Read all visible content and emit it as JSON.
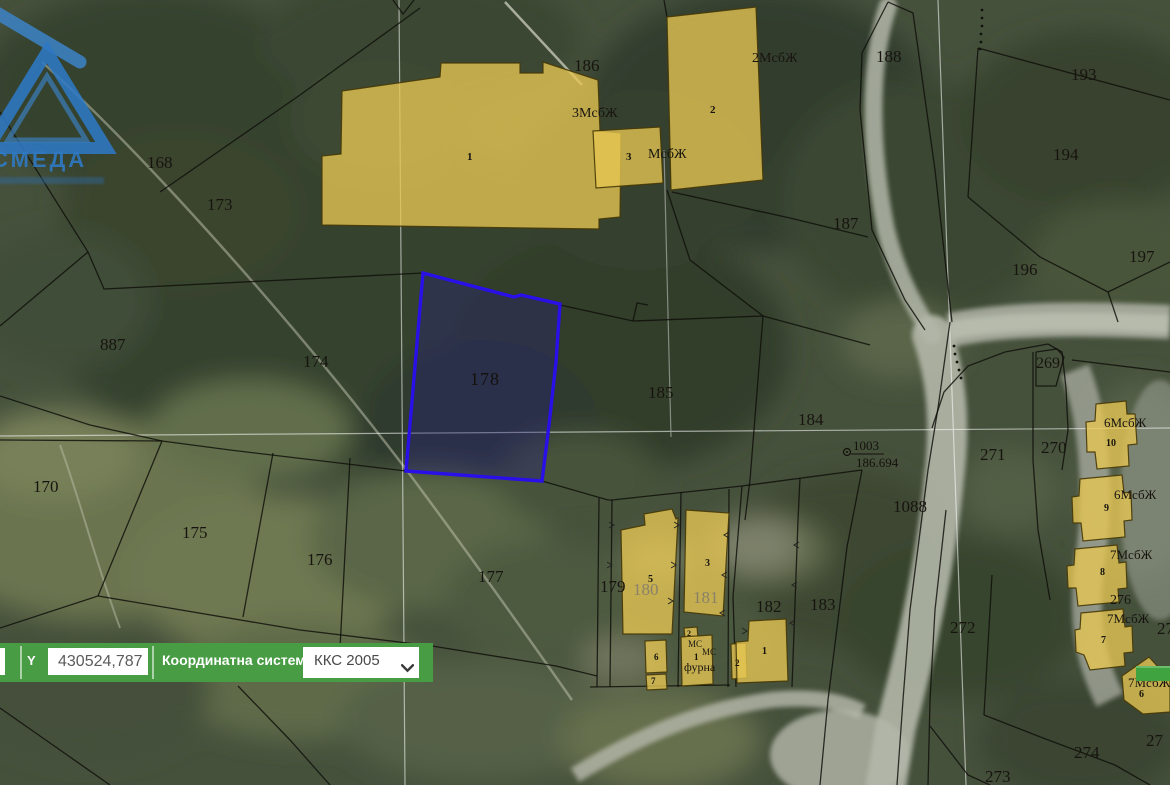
{
  "watermark": {
    "text": "СМЕДА"
  },
  "coordinate_bar": {
    "y_label": "Y",
    "y_value": "430524,787",
    "system_label": "Координатна система",
    "system_value": "ККС 2005"
  },
  "selected_parcel": {
    "number": "178"
  },
  "geodetic_point": {
    "id": "1003",
    "elevation": "186.694"
  },
  "colors": {
    "toolbar_green": "#489c44",
    "selection_blue": "#2a10e8",
    "building_yellow": "#e7c753"
  },
  "map": {
    "labels": [
      {
        "t": "168",
        "x": 147,
        "y": 168,
        "s": 17,
        "kind": "parcel-label"
      },
      {
        "t": "173",
        "x": 207,
        "y": 210,
        "s": 17,
        "kind": "parcel-label"
      },
      {
        "t": "887",
        "x": 100,
        "y": 350,
        "s": 17,
        "kind": "parcel-label"
      },
      {
        "t": "174",
        "x": 303,
        "y": 367,
        "s": 17,
        "kind": "parcel-label"
      },
      {
        "t": "170",
        "x": 33,
        "y": 492,
        "s": 17,
        "kind": "parcel-label"
      },
      {
        "t": "175",
        "x": 182,
        "y": 538,
        "s": 17,
        "kind": "parcel-label"
      },
      {
        "t": "176",
        "x": 307,
        "y": 565,
        "s": 17,
        "kind": "parcel-label"
      },
      {
        "t": "177",
        "x": 478,
        "y": 582,
        "s": 17,
        "kind": "parcel-label"
      },
      {
        "t": "179",
        "x": 600,
        "y": 592,
        "s": 17,
        "kind": "parcel-label"
      },
      {
        "t": "180",
        "x": 633,
        "y": 595,
        "s": 17,
        "c": "#8a8168",
        "kind": "parcel-label"
      },
      {
        "t": "181",
        "x": 693,
        "y": 603,
        "s": 17,
        "c": "#8a8168",
        "kind": "parcel-label"
      },
      {
        "t": "182",
        "x": 756,
        "y": 612,
        "s": 17,
        "kind": "parcel-label"
      },
      {
        "t": "183",
        "x": 810,
        "y": 610,
        "s": 17,
        "kind": "parcel-label"
      },
      {
        "t": "184",
        "x": 798,
        "y": 425,
        "s": 17,
        "kind": "parcel-label"
      },
      {
        "t": "185",
        "x": 648,
        "y": 398,
        "s": 17,
        "kind": "parcel-label"
      },
      {
        "t": "186",
        "x": 574,
        "y": 71,
        "s": 17,
        "kind": "parcel-label"
      },
      {
        "t": "187",
        "x": 833,
        "y": 229,
        "s": 17,
        "kind": "parcel-label"
      },
      {
        "t": "188",
        "x": 876,
        "y": 62,
        "s": 17,
        "kind": "parcel-label"
      },
      {
        "t": "193",
        "x": 1071,
        "y": 80,
        "s": 17,
        "kind": "parcel-label"
      },
      {
        "t": "194",
        "x": 1053,
        "y": 160,
        "s": 17,
        "kind": "parcel-label"
      },
      {
        "t": "196",
        "x": 1012,
        "y": 275,
        "s": 17,
        "kind": "parcel-label"
      },
      {
        "t": "197",
        "x": 1129,
        "y": 262,
        "s": 17,
        "kind": "parcel-label"
      },
      {
        "t": "269",
        "x": 1036,
        "y": 368,
        "s": 16,
        "kind": "parcel-label"
      },
      {
        "t": "270",
        "x": 1041,
        "y": 453,
        "s": 17,
        "kind": "parcel-label"
      },
      {
        "t": "271",
        "x": 980,
        "y": 460,
        "s": 17,
        "kind": "parcel-label"
      },
      {
        "t": "272",
        "x": 950,
        "y": 633,
        "s": 17,
        "kind": "parcel-label"
      },
      {
        "t": "273",
        "x": 985,
        "y": 782,
        "s": 17,
        "kind": "parcel-label"
      },
      {
        "t": "274",
        "x": 1074,
        "y": 758,
        "s": 17,
        "kind": "parcel-label"
      },
      {
        "t": "1088",
        "x": 893,
        "y": 512,
        "s": 17,
        "kind": "parcel-label"
      },
      {
        "t": "276",
        "x": 1110,
        "y": 604,
        "s": 14,
        "kind": "parcel-label"
      },
      {
        "t": "27",
        "x": 1157,
        "y": 634,
        "s": 17,
        "kind": "parcel-label"
      },
      {
        "t": "27",
        "x": 1146,
        "y": 746,
        "s": 17,
        "kind": "parcel-label"
      },
      {
        "t": "3МсбЖ",
        "x": 572,
        "y": 117,
        "s": 14,
        "kind": "building-label"
      },
      {
        "t": "МсбЖ",
        "x": 648,
        "y": 158,
        "s": 14,
        "kind": "building-label"
      },
      {
        "t": "2МсбЖ",
        "x": 752,
        "y": 62,
        "s": 14,
        "kind": "building-label"
      },
      {
        "t": "1",
        "x": 467,
        "y": 160,
        "s": 11,
        "w": 1,
        "kind": "building-label"
      },
      {
        "t": "2",
        "x": 710,
        "y": 113,
        "s": 11,
        "w": 1,
        "kind": "building-label"
      },
      {
        "t": "3",
        "x": 626,
        "y": 160,
        "s": 11,
        "w": 1,
        "kind": "building-label"
      },
      {
        "t": "6МсбЖ",
        "x": 1104,
        "y": 427,
        "s": 13,
        "kind": "building-label"
      },
      {
        "t": "10",
        "x": 1106,
        "y": 446,
        "s": 10,
        "w": 1,
        "kind": "building-label"
      },
      {
        "t": "6МсбЖ",
        "x": 1114,
        "y": 499,
        "s": 13,
        "kind": "building-label"
      },
      {
        "t": "9",
        "x": 1104,
        "y": 511,
        "s": 10,
        "w": 1,
        "kind": "building-label"
      },
      {
        "t": "7МсбЖ",
        "x": 1110,
        "y": 559,
        "s": 13,
        "kind": "building-label"
      },
      {
        "t": "8",
        "x": 1100,
        "y": 575,
        "s": 10,
        "w": 1,
        "kind": "building-label"
      },
      {
        "t": "7МсбЖ",
        "x": 1107,
        "y": 623,
        "s": 13,
        "kind": "building-label"
      },
      {
        "t": "7",
        "x": 1101,
        "y": 643,
        "s": 10,
        "w": 1,
        "kind": "building-label"
      },
      {
        "t": "7МсбЖ",
        "x": 1128,
        "y": 687,
        "s": 13,
        "kind": "building-label"
      },
      {
        "t": "6",
        "x": 1139,
        "y": 697,
        "s": 10,
        "w": 1,
        "kind": "building-label"
      },
      {
        "t": "5",
        "x": 648,
        "y": 582,
        "s": 10,
        "w": 1,
        "kind": "building-label"
      },
      {
        "t": "3",
        "x": 705,
        "y": 566,
        "s": 10,
        "w": 1,
        "kind": "building-label"
      },
      {
        "t": "6",
        "x": 654,
        "y": 660,
        "s": 9,
        "w": 1,
        "kind": "building-label"
      },
      {
        "t": "7",
        "x": 651,
        "y": 684,
        "s": 9,
        "w": 1,
        "kind": "building-label"
      },
      {
        "t": "2",
        "x": 687,
        "y": 636,
        "s": 8,
        "w": 1,
        "kind": "building-label"
      },
      {
        "t": "МС",
        "x": 688,
        "y": 647,
        "s": 9,
        "kind": "building-label"
      },
      {
        "t": "1",
        "x": 694,
        "y": 660,
        "s": 9,
        "w": 1,
        "kind": "building-label"
      },
      {
        "t": "МС",
        "x": 702,
        "y": 655,
        "s": 9,
        "kind": "building-label"
      },
      {
        "t": "фурна",
        "x": 684,
        "y": 671,
        "s": 12,
        "kind": "building-label"
      },
      {
        "t": "2",
        "x": 735,
        "y": 666,
        "s": 9,
        "w": 1,
        "kind": "building-label"
      },
      {
        "t": "1",
        "x": 762,
        "y": 654,
        "s": 10,
        "w": 1,
        "kind": "building-label"
      }
    ]
  }
}
